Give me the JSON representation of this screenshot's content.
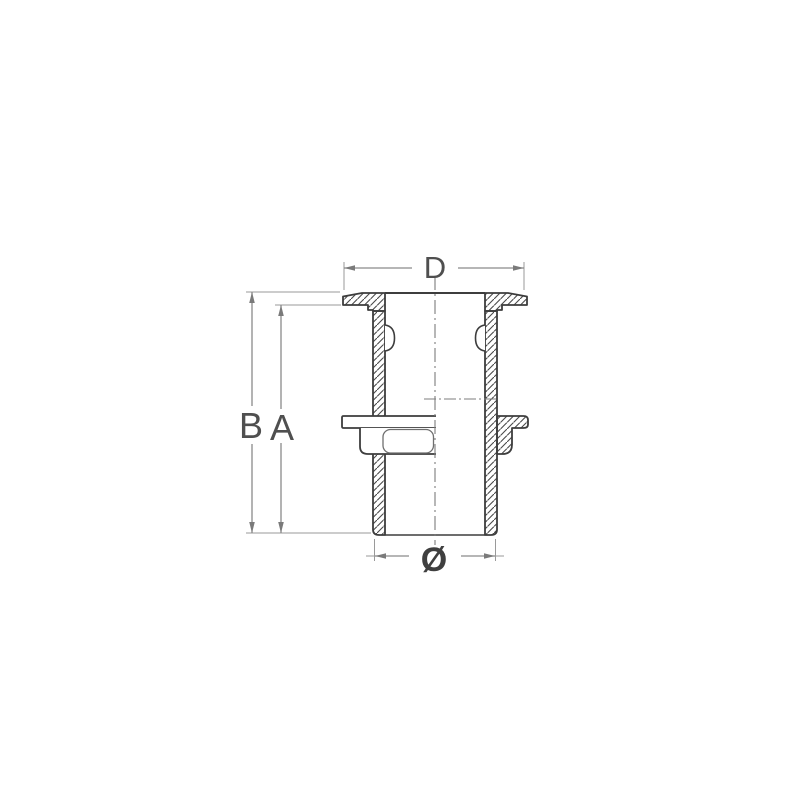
{
  "drawing": {
    "labels": {
      "flange_width": "D",
      "overall_length": "B",
      "thread_length": "A",
      "outer_diameter": "Ø"
    },
    "colors": {
      "background": "#ffffff",
      "part_outline": "#3d3d3d",
      "hatch": "#4a4a4a",
      "dimension_line": "#8a8a8a",
      "label_text": "#4f4f4f"
    }
  }
}
